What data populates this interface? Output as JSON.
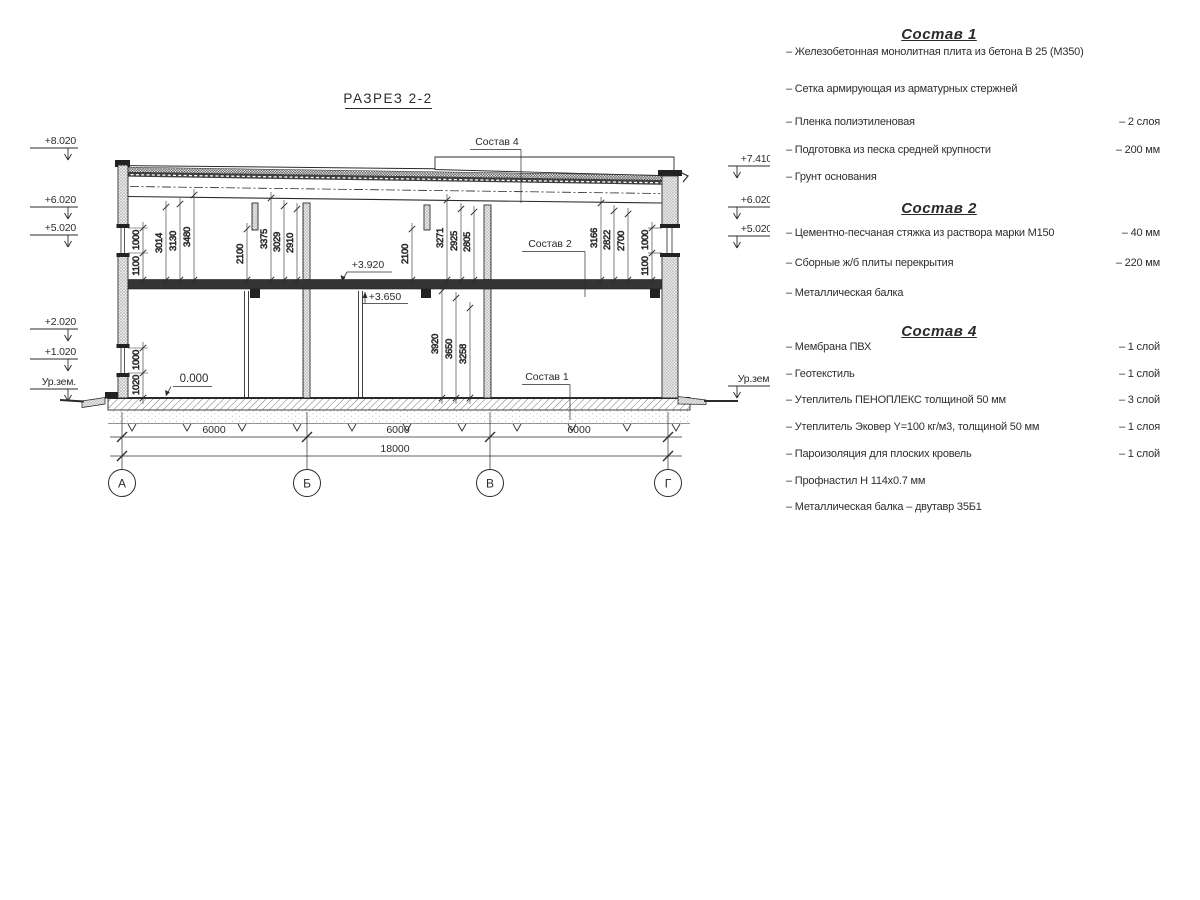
{
  "page": {
    "background": "#ffffff",
    "ink": "#2b2b2b"
  },
  "drawing": {
    "title": "РАЗРЕЗ 2-2",
    "marks_left": [
      "+8.020",
      "+6.020",
      "+5.020",
      "+2.020",
      "+1.020",
      "Ур.зем."
    ],
    "marks_right": [
      "+7.410",
      "+6.020",
      "+5.020",
      "Ур.зем."
    ],
    "levels": {
      "plus3920": "+3.920",
      "plus3650": "+3.650",
      "zero": "0.000"
    },
    "leaders": {
      "s4": "Состав 4",
      "s2": "Состав 2",
      "s1": "Состав 1"
    },
    "dims": {
      "win_up_left_h": "1000",
      "win_up_left_sill": "1100",
      "ab_1": "3014",
      "ab_2": "3130",
      "ab_3": "3480",
      "b_drop": "2100",
      "b_1": "3375",
      "b_2": "3029",
      "b_3": "2910",
      "v_drop": "2100",
      "v_1": "3271",
      "v_2": "2925",
      "v_3": "2805",
      "vg_1": "3166",
      "vg_2": "2822",
      "vg_3": "2700",
      "win_up_right_h": "1000",
      "win_up_right_sill": "1100",
      "win_lo_left_h": "1000",
      "win_lo_left_sill": "1020",
      "lo_1": "3920",
      "lo_2": "3650",
      "lo_3": "3258"
    },
    "bottom_dims": [
      "6000",
      "6000",
      "6000"
    ],
    "total_dim": "18000",
    "axes": [
      "А",
      "Б",
      "В",
      "Г"
    ]
  },
  "specs": [
    {
      "title": "Состав 1",
      "items": [
        {
          "name": "– Железобетонная  монолитная плита из бетона В 25 (М350)",
          "value": ""
        },
        {
          "name": "– Сетка армирующая из арматурных стержней",
          "value": ""
        },
        {
          "name": "– Пленка полиэтиленовая",
          "value": "– 2 слоя"
        },
        {
          "name": "– Подготовка из песка средней крупности",
          "value": "– 200 мм"
        },
        {
          "name": "– Грунт основания",
          "value": ""
        }
      ]
    },
    {
      "title": "Состав 2",
      "items": [
        {
          "name": "– Цементно-песчаная стяжка из раствора марки М150",
          "value": "– 40 мм"
        },
        {
          "name": "– Сборные ж/б плиты перекрытия",
          "value": "– 220 мм"
        },
        {
          "name": "– Металлическая балка",
          "value": ""
        }
      ]
    },
    {
      "title": "Состав 4",
      "items": [
        {
          "name": "– Мембрана ПВХ",
          "value": "– 1 слой"
        },
        {
          "name": "– Геотекстиль",
          "value": "– 1 слой"
        },
        {
          "name": "– Утеплитель ПЕНОПЛЕКС толщиной 50 мм",
          "value": "– 3 слой"
        },
        {
          "name": "– Утеплитель Эковер Y=100 кг/м3, толщиной 50 мм",
          "value": "– 1 слоя"
        },
        {
          "name": "– Пароизоляция для плоских кровель",
          "value": "– 1 слой"
        },
        {
          "name": "– Профнастил Н 114х0.7 мм",
          "value": ""
        },
        {
          "name": "– Металлическая балка – двутавр 35Б1",
          "value": ""
        }
      ]
    }
  ]
}
